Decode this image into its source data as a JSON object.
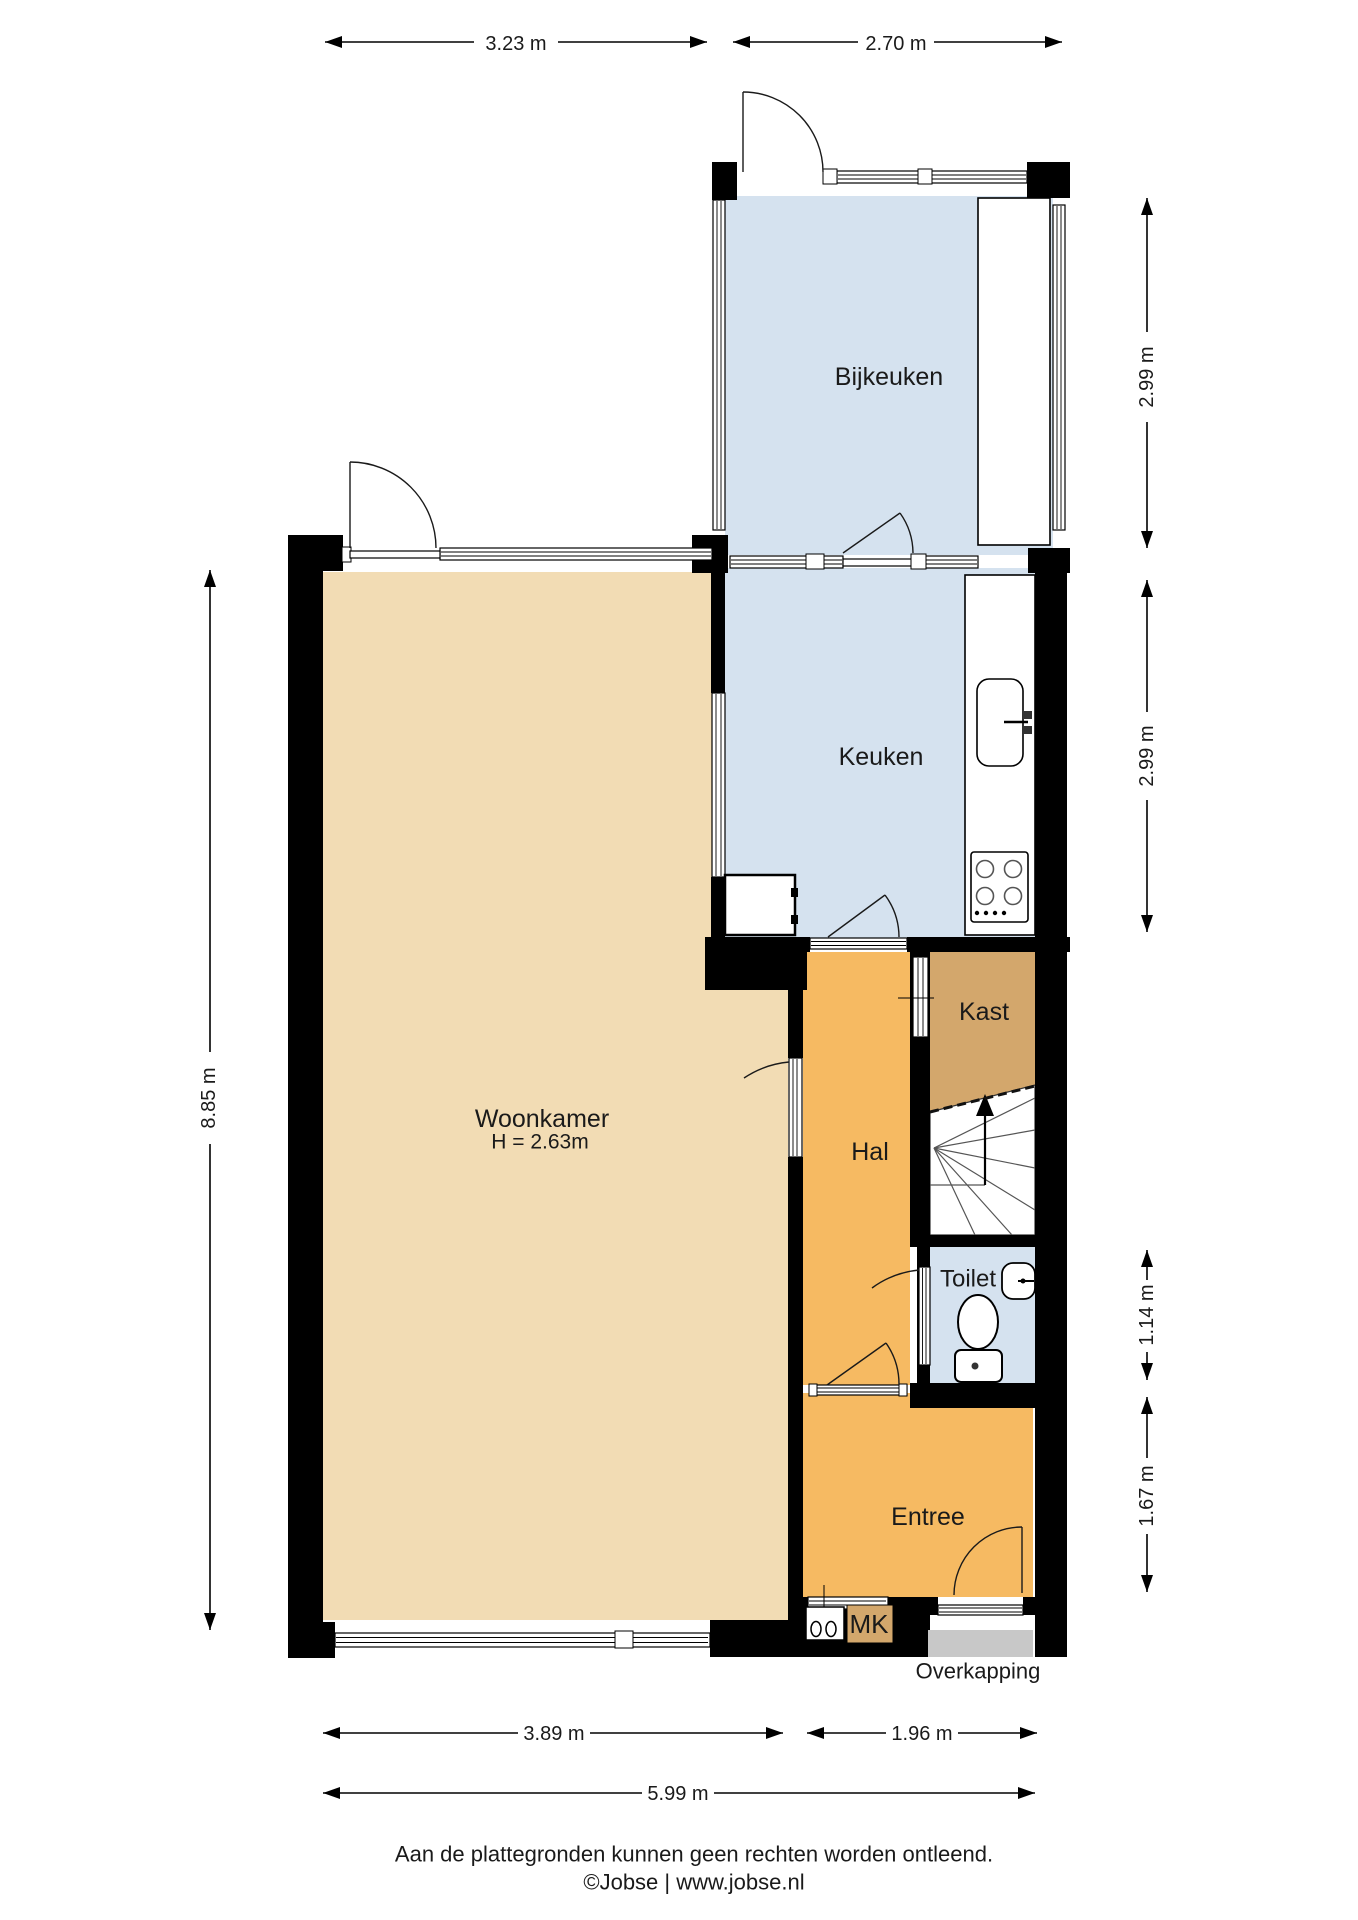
{
  "plan_title": "Begane grond plattegrond",
  "rooms": {
    "bijkeuken": {
      "label": "Bijkeuken"
    },
    "keuken": {
      "label": "Keuken"
    },
    "kast": {
      "label": "Kast"
    },
    "hal": {
      "label": "Hal"
    },
    "woonkamer": {
      "label": "Woonkamer",
      "height_note": "H = 2.63m"
    },
    "toilet": {
      "label": "Toilet"
    },
    "entree": {
      "label": "Entree"
    },
    "meterkast": {
      "label": "MK"
    },
    "overkapping": {
      "label": "Overkapping"
    }
  },
  "dimensions": {
    "top_left_width": "3.23 m",
    "top_right_width": "2.70 m",
    "left_height": "8.85 m",
    "right_bijkeuken_height": "2.99 m",
    "right_keuken_height": "2.99 m",
    "right_toilet_height": "1.14 m",
    "right_entree_height": "1.67 m",
    "bottom_woonkamer_width": "3.89 m",
    "bottom_hal_width": "1.96 m",
    "bottom_total_width": "5.99 m"
  },
  "footer": {
    "disclaimer": "Aan de plattegronden kunnen geen rechten worden ontleend.",
    "credit": "©Jobse | www.jobse.nl"
  },
  "colors": {
    "wall": "#000000",
    "wet_room_blue": "#d5e2ef",
    "living_tan": "#f2dcb4",
    "hall_orange": "#f6ba62",
    "closet_tan": "#d3a76c",
    "overkapping_gray": "#c8c8c8"
  }
}
